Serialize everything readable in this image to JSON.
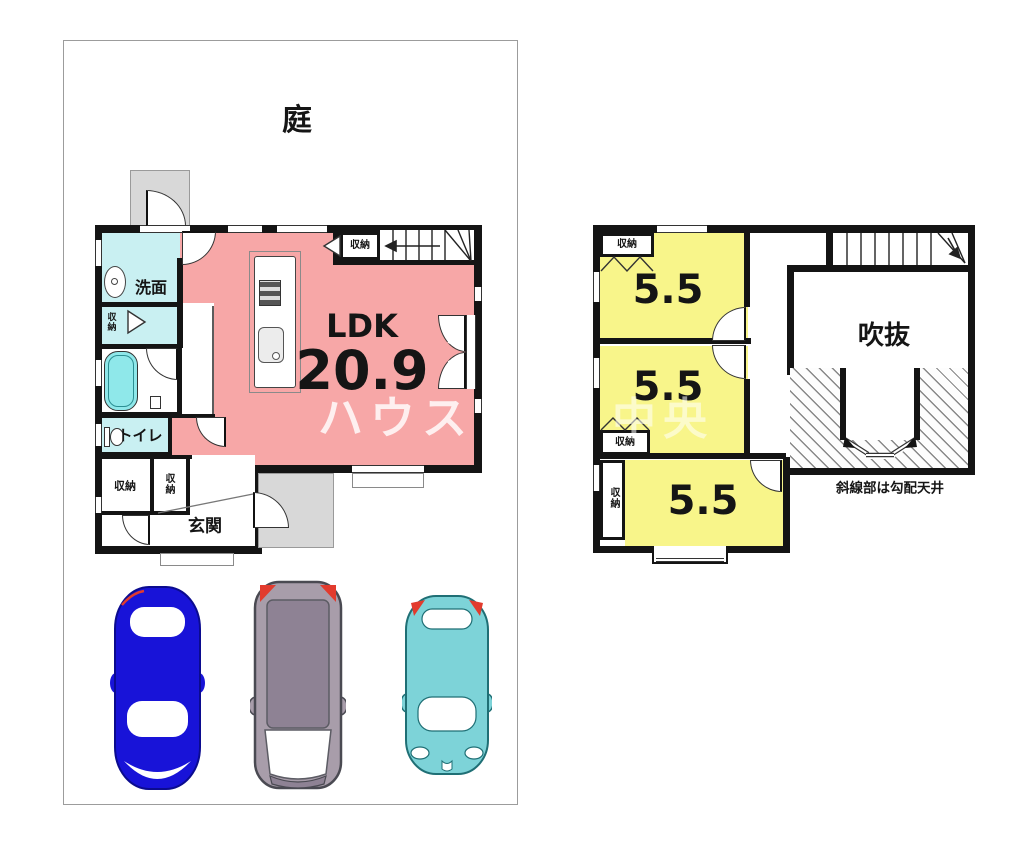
{
  "floor1": {
    "garden_label": "庭",
    "washroom_label": "洗面",
    "niche_closet_label": "収納",
    "toilet_label": "トイレ",
    "closet_left_label": "収納",
    "closet_right_label": "収納",
    "entrance_label": "玄関",
    "stair_closet_label": "収納",
    "ldk_label": "LDK",
    "ldk_area": "20.9"
  },
  "floor2": {
    "closet_top_label": "収納",
    "room1_area": "5.5",
    "room2_area": "5.5",
    "room3_area": "5.5",
    "closet_mid_label": "収納",
    "closet_column_label": "収納",
    "void_label": "吹抜",
    "note": "斜線部は勾配天井"
  },
  "watermark": {
    "part1": "ハウスド",
    "part2": "中央"
  },
  "colors": {
    "wall": "#141414",
    "pink": "#f7a7a7",
    "cyan": "#c9f0f2",
    "tub": "#8fe8ea",
    "yellow": "#f8f58a",
    "porch": "#d8d8d8",
    "car-blue": "#1813d8",
    "car-gray": "#a89daa",
    "car-roof": "#8e8294",
    "car-teal": "#7dd3d8",
    "accent-red": "#e23b2e"
  }
}
